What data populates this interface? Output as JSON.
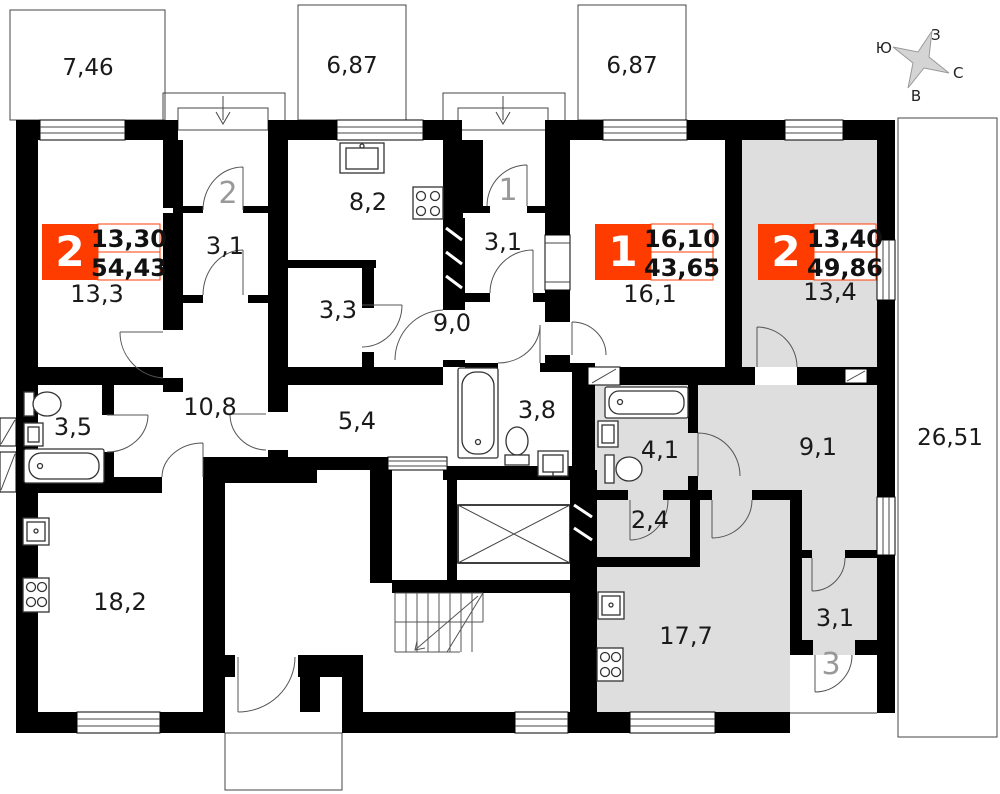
{
  "compass": {
    "west": "З",
    "south": "Ю",
    "north": "С",
    "east": "В"
  },
  "balconies": [
    {
      "area": "7,46"
    },
    {
      "area": "6,87"
    },
    {
      "area": "6,87"
    },
    {
      "area": "26,51"
    }
  ],
  "apartments": [
    {
      "number": "2",
      "living_area": "13,30",
      "total_area": "54,43"
    },
    {
      "number": "1",
      "living_area": "16,10",
      "total_area": "43,65"
    },
    {
      "number": "2",
      "living_area": "13,40",
      "total_area": "49,86"
    }
  ],
  "entrances": [
    {
      "label": "2"
    },
    {
      "label": "1"
    },
    {
      "label": "3"
    }
  ],
  "rooms": [
    {
      "area": "13,3"
    },
    {
      "area": "3,1"
    },
    {
      "area": "8,2"
    },
    {
      "area": "3,3"
    },
    {
      "area": "9,0"
    },
    {
      "area": "3,1"
    },
    {
      "area": "16,1"
    },
    {
      "area": "13,4"
    },
    {
      "area": "3,5"
    },
    {
      "area": "10,8"
    },
    {
      "area": "5,4"
    },
    {
      "area": "3,8"
    },
    {
      "area": "4,1"
    },
    {
      "area": "9,1"
    },
    {
      "area": "2,4"
    },
    {
      "area": "18,2"
    },
    {
      "area": "17,7"
    },
    {
      "area": "3,1"
    }
  ],
  "colors": {
    "badge": "#ff3c00",
    "highlight": "#dedede",
    "wall": "#000000",
    "entrance_label": "#999999"
  }
}
